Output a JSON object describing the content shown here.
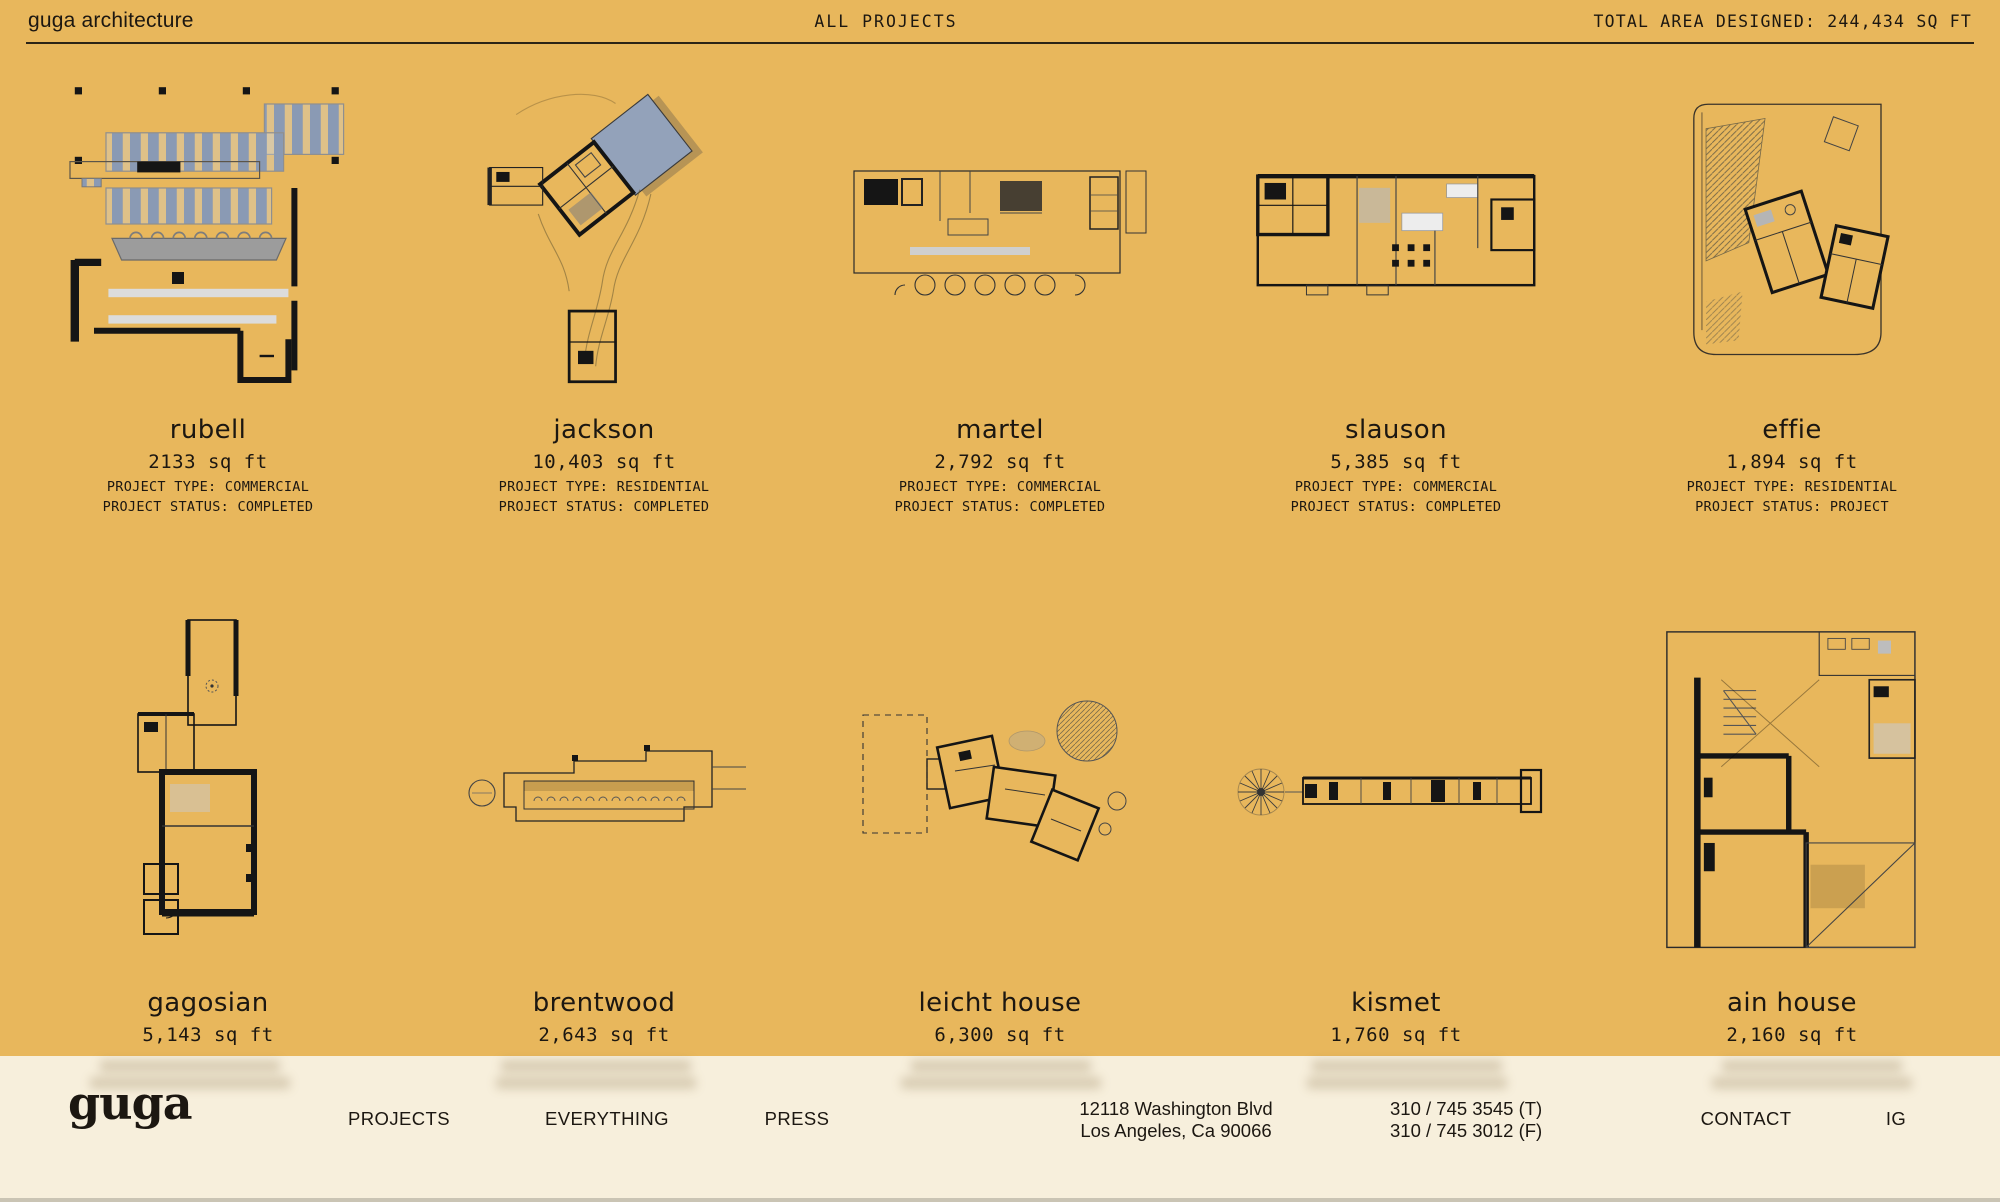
{
  "colors": {
    "background": "#e8b75c",
    "footer_background": "#f7efdc",
    "ink": "#1c1711"
  },
  "header": {
    "brand": "guga architecture",
    "center": "ALL PROJECTS",
    "total": "TOTAL AREA DESIGNED: 244,434 SQ FT"
  },
  "projects": [
    {
      "name": "rubell",
      "area": "2133 sq ft",
      "type": "PROJECT TYPE: COMMERCIAL",
      "status": "PROJECT STATUS: COMPLETED"
    },
    {
      "name": "jackson",
      "area": "10,403 sq ft",
      "type": "PROJECT TYPE: RESIDENTIAL",
      "status": "PROJECT STATUS: COMPLETED"
    },
    {
      "name": "martel",
      "area": "2,792 sq ft",
      "type": "PROJECT TYPE: COMMERCIAL",
      "status": "PROJECT STATUS: COMPLETED"
    },
    {
      "name": "slauson",
      "area": "5,385 sq ft",
      "type": "PROJECT TYPE: COMMERCIAL",
      "status": "PROJECT STATUS: COMPLETED"
    },
    {
      "name": "effie",
      "area": "1,894 sq ft",
      "type": "PROJECT TYPE: RESIDENTIAL",
      "status": "PROJECT STATUS: PROJECT"
    },
    {
      "name": "gagosian",
      "area": "5,143 sq ft"
    },
    {
      "name": "brentwood",
      "area": "2,643 sq ft"
    },
    {
      "name": "leicht house",
      "area": "6,300 sq ft"
    },
    {
      "name": "kismet",
      "area": "1,760 sq ft"
    },
    {
      "name": "ain house",
      "area": "2,160 sq ft"
    }
  ],
  "footer": {
    "logo": "guga",
    "nav": [
      "PROJECTS",
      "EVERYTHING",
      "PRESS"
    ],
    "address_line1": "12118 Washington Blvd",
    "address_line2": "Los Angeles, Ca 90066",
    "phone_t": "310 / 745 3545 (T)",
    "phone_f": "310 / 745 3012 (F)",
    "contact": "CONTACT",
    "ig": "IG"
  }
}
